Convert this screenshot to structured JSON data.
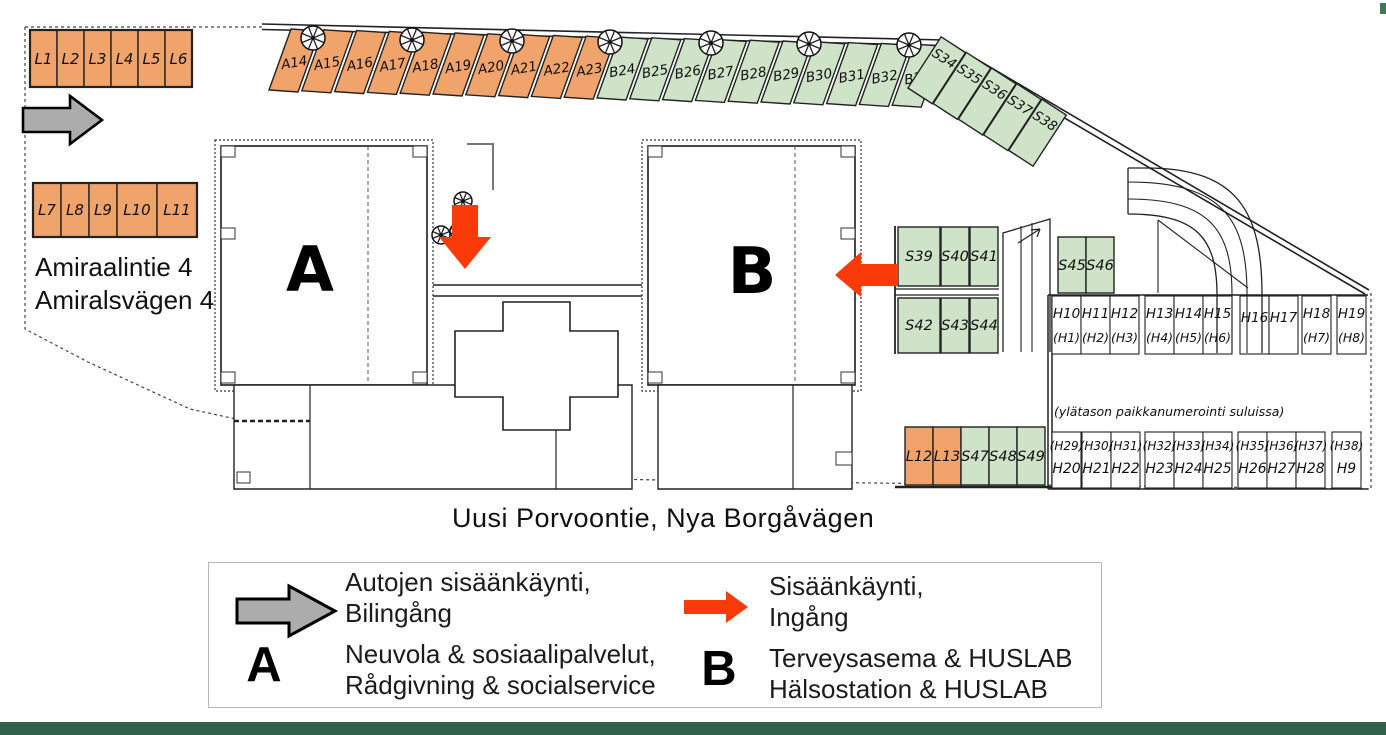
{
  "map": {
    "streets": {
      "left": [
        "Amiraalintie 4",
        "Amiralsvägen 4"
      ],
      "bottom": "Uusi Porvoontie, Nya Borgåvägen"
    },
    "upper_level_note": "(ylätason paikkanumerointi suluissa)",
    "building_labels": [
      "A",
      "B"
    ],
    "colors": {
      "orange": "#F1A36C",
      "green": "#CEE3C8",
      "red": "#FB3A09",
      "gray": "#ACACAC",
      "footer_green": "#33604A",
      "tick_green": "#3E7B52",
      "line": "#222222"
    },
    "stalls": {
      "l_top": [
        "L1",
        "L2",
        "L3",
        "L4",
        "L5",
        "L6"
      ],
      "l_left": [
        "L7",
        "L8",
        "L9",
        "L10",
        "L11"
      ],
      "diagonal": [
        {
          "label": "A14",
          "color": "orange"
        },
        {
          "label": "A15",
          "color": "orange"
        },
        {
          "label": "A16",
          "color": "orange"
        },
        {
          "label": "A17",
          "color": "orange"
        },
        {
          "label": "A18",
          "color": "orange"
        },
        {
          "label": "A19",
          "color": "orange"
        },
        {
          "label": "A20",
          "color": "orange"
        },
        {
          "label": "A21",
          "color": "orange"
        },
        {
          "label": "A22",
          "color": "orange"
        },
        {
          "label": "A23",
          "color": "orange"
        },
        {
          "label": "B24",
          "color": "green"
        },
        {
          "label": "B25",
          "color": "green"
        },
        {
          "label": "B26",
          "color": "green"
        },
        {
          "label": "B27",
          "color": "green"
        },
        {
          "label": "B28",
          "color": "green"
        },
        {
          "label": "B29",
          "color": "green"
        },
        {
          "label": "B30",
          "color": "green"
        },
        {
          "label": "B31",
          "color": "green"
        },
        {
          "label": "B32",
          "color": "green"
        },
        {
          "label": "B33",
          "color": "green"
        }
      ],
      "diagonal_end": [
        "S34",
        "S35",
        "S36",
        "S37",
        "S38"
      ],
      "s_upper": [
        "S39",
        "S40",
        "S41"
      ],
      "s_lower": [
        "S42",
        "S43",
        "S44"
      ],
      "s_pair": [
        "S45",
        "S46"
      ],
      "h_upper": [
        {
          "top": "H10",
          "bottom": "(H1)"
        },
        {
          "top": "H11",
          "bottom": "(H2)"
        },
        {
          "top": "H12",
          "bottom": "(H3)"
        },
        {
          "top": "H13",
          "bottom": "(H4)"
        },
        {
          "top": "H14",
          "bottom": "(H5)"
        },
        {
          "top": "H15",
          "bottom": "(H6)"
        },
        {
          "top": "H16",
          "bottom": ""
        },
        {
          "top": "H17",
          "bottom": ""
        },
        {
          "top": "H18",
          "bottom": "(H7)"
        },
        {
          "top": "H19",
          "bottom": "(H8)"
        }
      ],
      "h_lower": [
        {
          "top": "(H29)",
          "bottom": "H20"
        },
        {
          "top": "(H30)",
          "bottom": "H21"
        },
        {
          "top": "(H31)",
          "bottom": "H22"
        },
        {
          "top": "(H32)",
          "bottom": "H23"
        },
        {
          "top": "(H33)",
          "bottom": "H24"
        },
        {
          "top": "(H34)",
          "bottom": "H25"
        },
        {
          "top": "(H35)",
          "bottom": "H26"
        },
        {
          "top": "(H36)",
          "bottom": "H27"
        },
        {
          "top": "(H37)",
          "bottom": "H28"
        },
        {
          "top": "(H38)",
          "bottom": "H9"
        }
      ],
      "mixed_bottom": [
        {
          "label": "L12",
          "color": "orange"
        },
        {
          "label": "L13",
          "color": "orange"
        },
        {
          "label": "S47",
          "color": "green"
        },
        {
          "label": "S48",
          "color": "green"
        },
        {
          "label": "S49",
          "color": "green"
        }
      ]
    }
  },
  "legend": {
    "car_entrance": {
      "lines": [
        "Autojen sisäänkäynti,",
        "Bilingång"
      ]
    },
    "entrance": {
      "lines": [
        "Sisäänkäynti,",
        "Ingång"
      ]
    },
    "building_a": {
      "letter": "A",
      "lines": [
        "Neuvola & sosiaalipalvelut,",
        "Rådgivning & socialservice"
      ]
    },
    "building_b": {
      "letter": "B",
      "lines": [
        "Terveysasema & HUSLAB",
        "Hälsostation & HUSLAB"
      ]
    }
  }
}
